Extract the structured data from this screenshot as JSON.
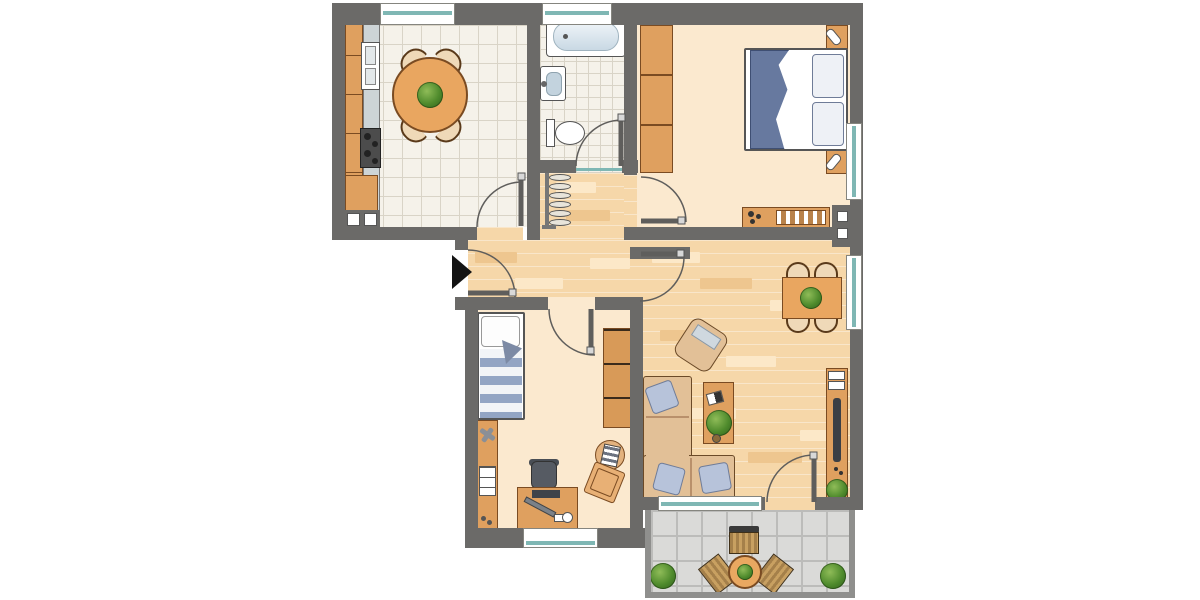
{
  "plan": {
    "type": "apartment-floor-plan",
    "entrance_marker": "black arrow pointing right at apartment door",
    "colors": {
      "wall": "#6b6a68",
      "wood_furniture": "#dfa05f",
      "parquet_floor": "#f6d7a9",
      "tile_floor": "#f5f2ea",
      "plain_floor": "#fbe9cf",
      "balcony_tile": "#dadad8",
      "window_glass": "#7fb7b4",
      "textile_blue": "#b7c3da",
      "blanket_blue": "#67799f"
    },
    "rooms": {
      "kitchen": {
        "label": "Kitchen",
        "floor": "tile",
        "furniture": [
          "kitchenette with sink and stove",
          "round dining table",
          "4 chairs",
          "potted plant"
        ]
      },
      "bathroom": {
        "label": "Bathroom",
        "floor": "tile",
        "furniture": [
          "bathtub",
          "washbasin",
          "toilet"
        ]
      },
      "bedroom": {
        "label": "Bedroom",
        "floor": "plain",
        "furniture": [
          "wardrobe",
          "double bed",
          "2 bedside tables with lamps",
          "sideboard with radiator"
        ]
      },
      "hallway": {
        "label": "Hallway",
        "floor": "parquet",
        "furniture": [
          "coat rack with hangers",
          "entrance door"
        ]
      },
      "childrens_room": {
        "label": "Children's room",
        "floor": "plain",
        "furniture": [
          "single bed",
          "wall shelf",
          "desk",
          "desk chair",
          "stool",
          "floor cushion",
          "wardrobe"
        ]
      },
      "living_room": {
        "label": "Living room",
        "floor": "parquet",
        "furniture": [
          "corner sofa with cushions",
          "coffee table with plant",
          "armchair",
          "dining table",
          "4 chairs",
          "TV sideboard",
          "potted plant"
        ]
      },
      "balcony": {
        "label": "Balcony",
        "floor": "tile",
        "furniture": [
          "bistro table",
          "3 chairs",
          "2 potted plants"
        ]
      }
    }
  }
}
